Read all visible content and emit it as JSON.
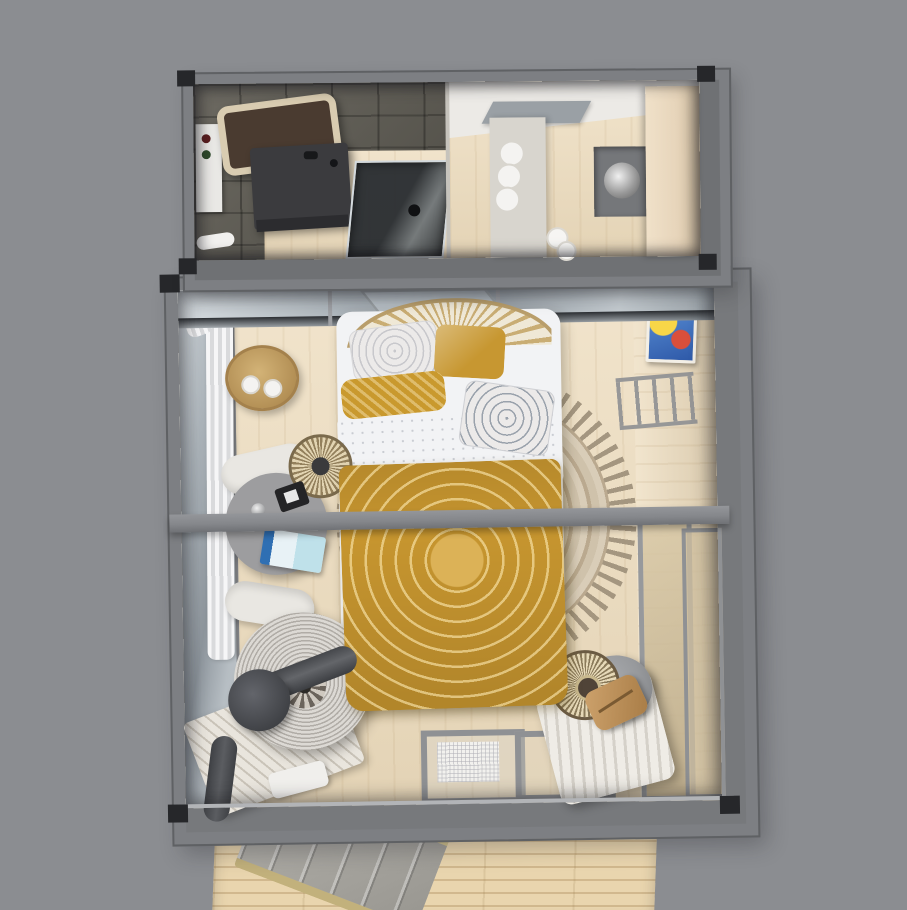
{
  "scene": {
    "type": "3d-floorplan-render",
    "description": "Top-down 3D render of a two-module container tiny house: bathroom and utility module on top, bedroom module below, wooden deck with stone steps at the bottom",
    "background_color": "#8b8d91"
  },
  "palette": {
    "bg": "#8b8d91",
    "wall": "#7d7f83",
    "wall-dark": "#5f6164",
    "casting": "#26272a",
    "wood": "#eddcbd",
    "wood-deck": "#e9d5ae",
    "tile": "#5e5c55",
    "vanity": "#3b3b3e",
    "tub-rim": "#d9ccb1",
    "tub-basin": "#4a3b30",
    "glass-hi": "#d7dde1",
    "glass-lo": "#8f979e",
    "counter": "#d8d5ce",
    "cabinet": "#e7d5bb",
    "duvet": "#c6952f",
    "duvet-hi": "#dcb257",
    "pillow-white": "#eceae9",
    "sheet": "#f2f3f5",
    "rug": "#baa98f",
    "rug-hi": "#d9cdb8",
    "rattan": "#c9ad74",
    "beam": "#85878b",
    "chair": "#e9e7e2",
    "table": "#9d9d9f",
    "wicker": "#dcd9d4",
    "pipe": "#46484c",
    "lounger": "#efece6",
    "armchair": "#97999c",
    "steps": "#a9a7a1",
    "step-edge": "#cfc08b",
    "curtain": "#f6f6f7"
  },
  "objects": {
    "upper_module": {
      "label": "Bathroom and utility module"
    },
    "bathtub": {
      "label": "Bathtub with cream rim"
    },
    "vanity": {
      "label": "Dark bathroom vanity with sink"
    },
    "shower": {
      "label": "Glass shower enclosure"
    },
    "toiletry_shelf": {
      "label": "White toiletry shelf"
    },
    "utility_counter": {
      "label": "Utility counter with rolled towels"
    },
    "tall_cabinet": {
      "label": "Tall cream storage cabinet"
    },
    "appliance": {
      "label": "Washer alcove with steel drum"
    },
    "skylight_mat": {
      "label": "Gray floor mat"
    },
    "lower_module": {
      "label": "Bedroom module"
    },
    "bed": {
      "label": "Double bed with mustard mandala duvet"
    },
    "headboard": {
      "label": "Rattan fan headboard"
    },
    "pillow_macrame": {
      "label": "White macrame pillow"
    },
    "pillow_mustard": {
      "label": "Mustard pillow"
    },
    "pillow_bolster": {
      "label": "Mustard bolster pillow"
    },
    "pillow_mandala": {
      "label": "White mandala pillow"
    },
    "sheet_fold": {
      "label": "Folded white sheet"
    },
    "round_rug": {
      "label": "Round tasseled jute rug"
    },
    "ceiling_beam": {
      "label": "Gray cross beam"
    },
    "side_table": {
      "label": "Rattan side table with cups"
    },
    "desk_table": {
      "label": "Round gray table with clock and book"
    },
    "clock": {
      "label": "Black desk clock"
    },
    "book": {
      "label": "Blue magazine"
    },
    "chair_top": {
      "label": "White chair"
    },
    "chair_bottom": {
      "label": "White chair"
    },
    "wall_light": {
      "label": "Woven rattan wall light"
    },
    "papasan": {
      "label": "Round woven lounge chair"
    },
    "stove_pipe": {
      "label": "Dark stove flue pipe"
    },
    "throw": {
      "label": "Striped fringed throw"
    },
    "towels": {
      "label": "Folded white towels"
    },
    "lounger": {
      "label": "White ribbed daybed lounger"
    },
    "armchair": {
      "label": "Gray armchair"
    },
    "floor_lamp": {
      "label": "Rattan floor lamp"
    },
    "leather_bag": {
      "label": "Tan leather accessory"
    },
    "artwork": {
      "label": "Colorful wall artwork"
    },
    "ladder_rack": {
      "label": "Ladder clothes rack"
    },
    "curtains": {
      "label": "Sheer white curtains"
    },
    "glass_doors": {
      "label": "Sliding glass doors with doormat"
    },
    "doormat": {
      "label": "White doormat"
    },
    "deck": {
      "label": "Wooden deck"
    },
    "stone_steps": {
      "label": "Stone step ramp with khaki edges"
    }
  }
}
